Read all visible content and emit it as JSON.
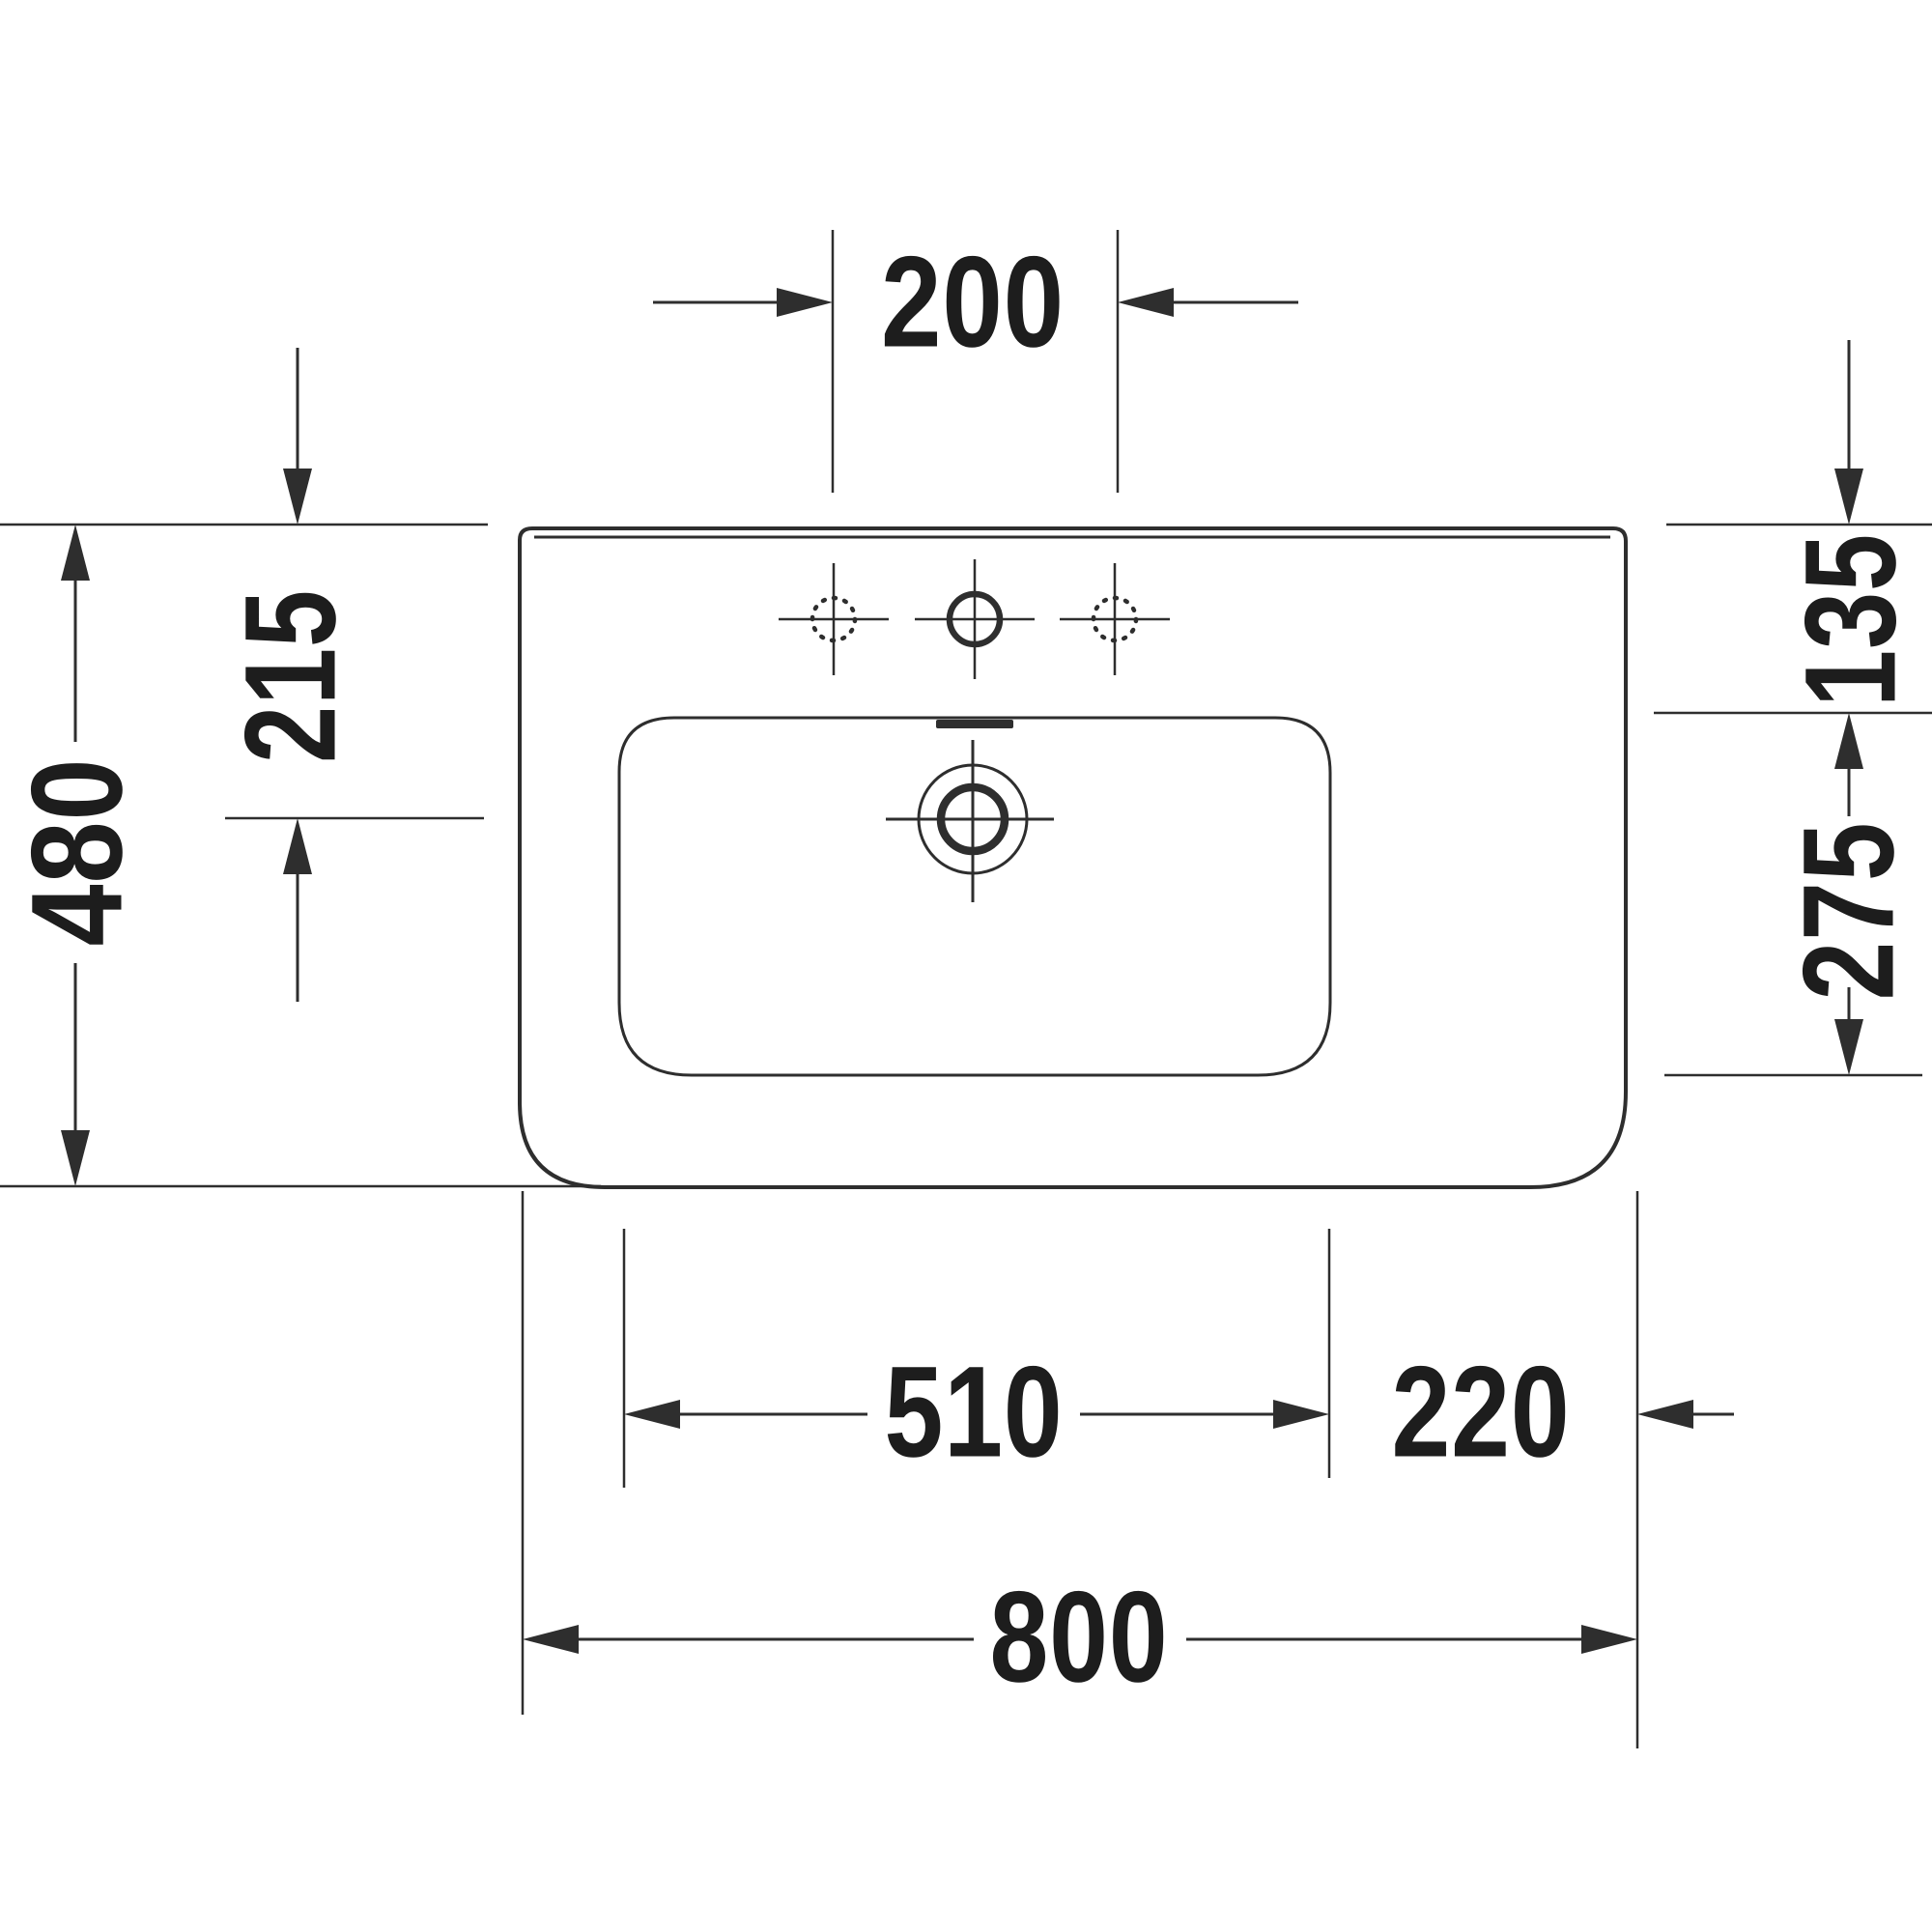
{
  "drawing": {
    "kind": "washbasin technical dimension drawing (top view)",
    "unit": "mm",
    "colors": {
      "line": "#2e2e2e",
      "text": "#1d1d1d",
      "background": "#ffffff"
    },
    "labels": {
      "tap_hole_spacing": "200",
      "back_edge_to_bowl_top": "135",
      "bowl_front_to_back": "275",
      "total_depth": "480",
      "back_edge_to_drain": "215",
      "bowl_width": "510",
      "bowl_to_right_edge": "220",
      "total_width": "800"
    }
  }
}
